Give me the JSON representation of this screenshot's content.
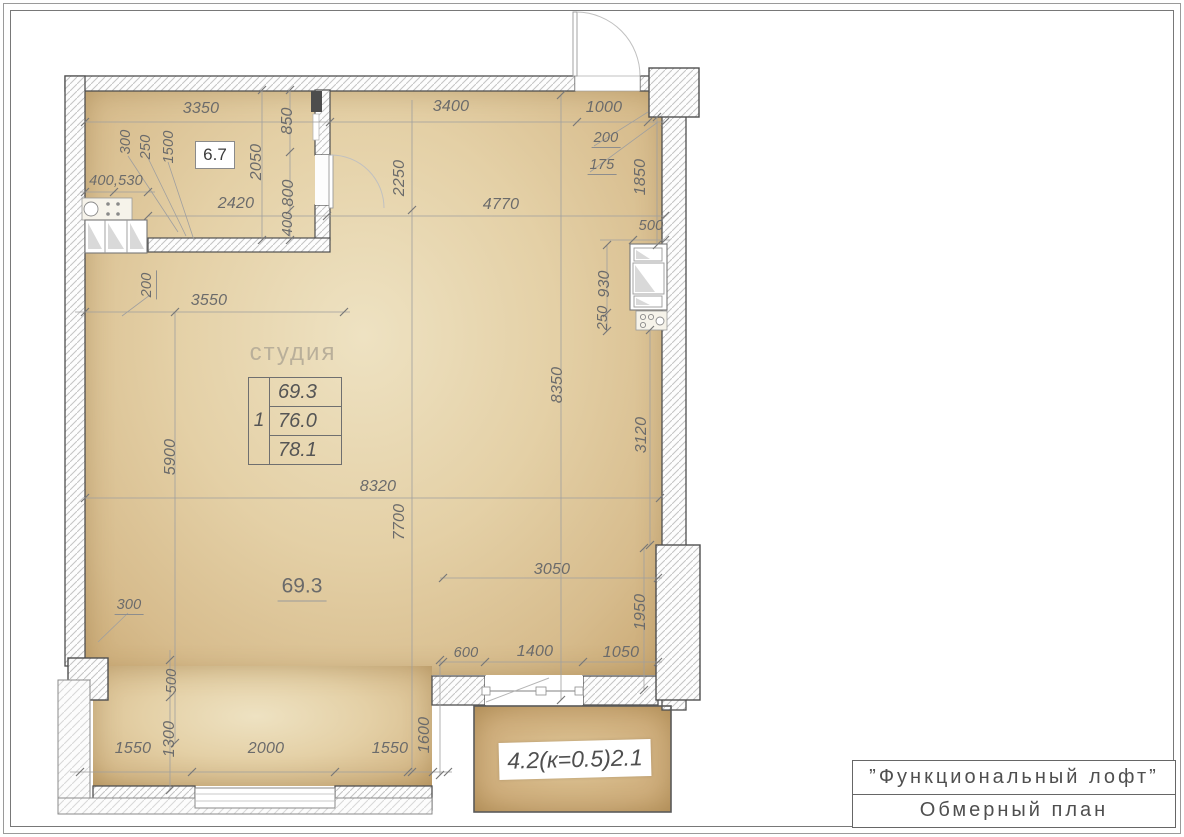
{
  "title_block": {
    "project_name": "”Функциональный лофт”",
    "drawing_name": "Обмерный план"
  },
  "room": {
    "name_label": "студия",
    "flat_number": "1",
    "area_rows": [
      "69.3",
      "76.0",
      "78.1"
    ],
    "floor_area_label": "69.3",
    "small_room_area": "6.7",
    "balcony_area_label": "4.2(к=0.5)2.1"
  },
  "dims": {
    "d3350": "3350",
    "d3400": "3400",
    "d1000": "1000",
    "d200tr": "200",
    "d175": "175",
    "d1850": "1850",
    "d850": "850",
    "d2050": "2050",
    "d1500": "1500",
    "d250tl": "250",
    "d300tl": "300",
    "d400_530": "400,530",
    "d2420": "2420",
    "d800": "800",
    "d400p": "400",
    "d2250": "2250",
    "d4770": "4770",
    "d500tr": "500",
    "d930": "930",
    "d250r": "250",
    "d200l": "200",
    "d3550": "3550",
    "d5900": "5900",
    "d8350": "8350",
    "d3120": "3120",
    "d8320": "8320",
    "d7700": "7700",
    "d3050": "3050",
    "d1950": "1950",
    "d300bl": "300",
    "d500bl": "500",
    "d600": "600",
    "d1400": "1400",
    "d1050": "1050",
    "d1550a": "1550",
    "d1300": "1300",
    "d2000": "2000",
    "d1550b": "1550",
    "d1600": "1600"
  }
}
